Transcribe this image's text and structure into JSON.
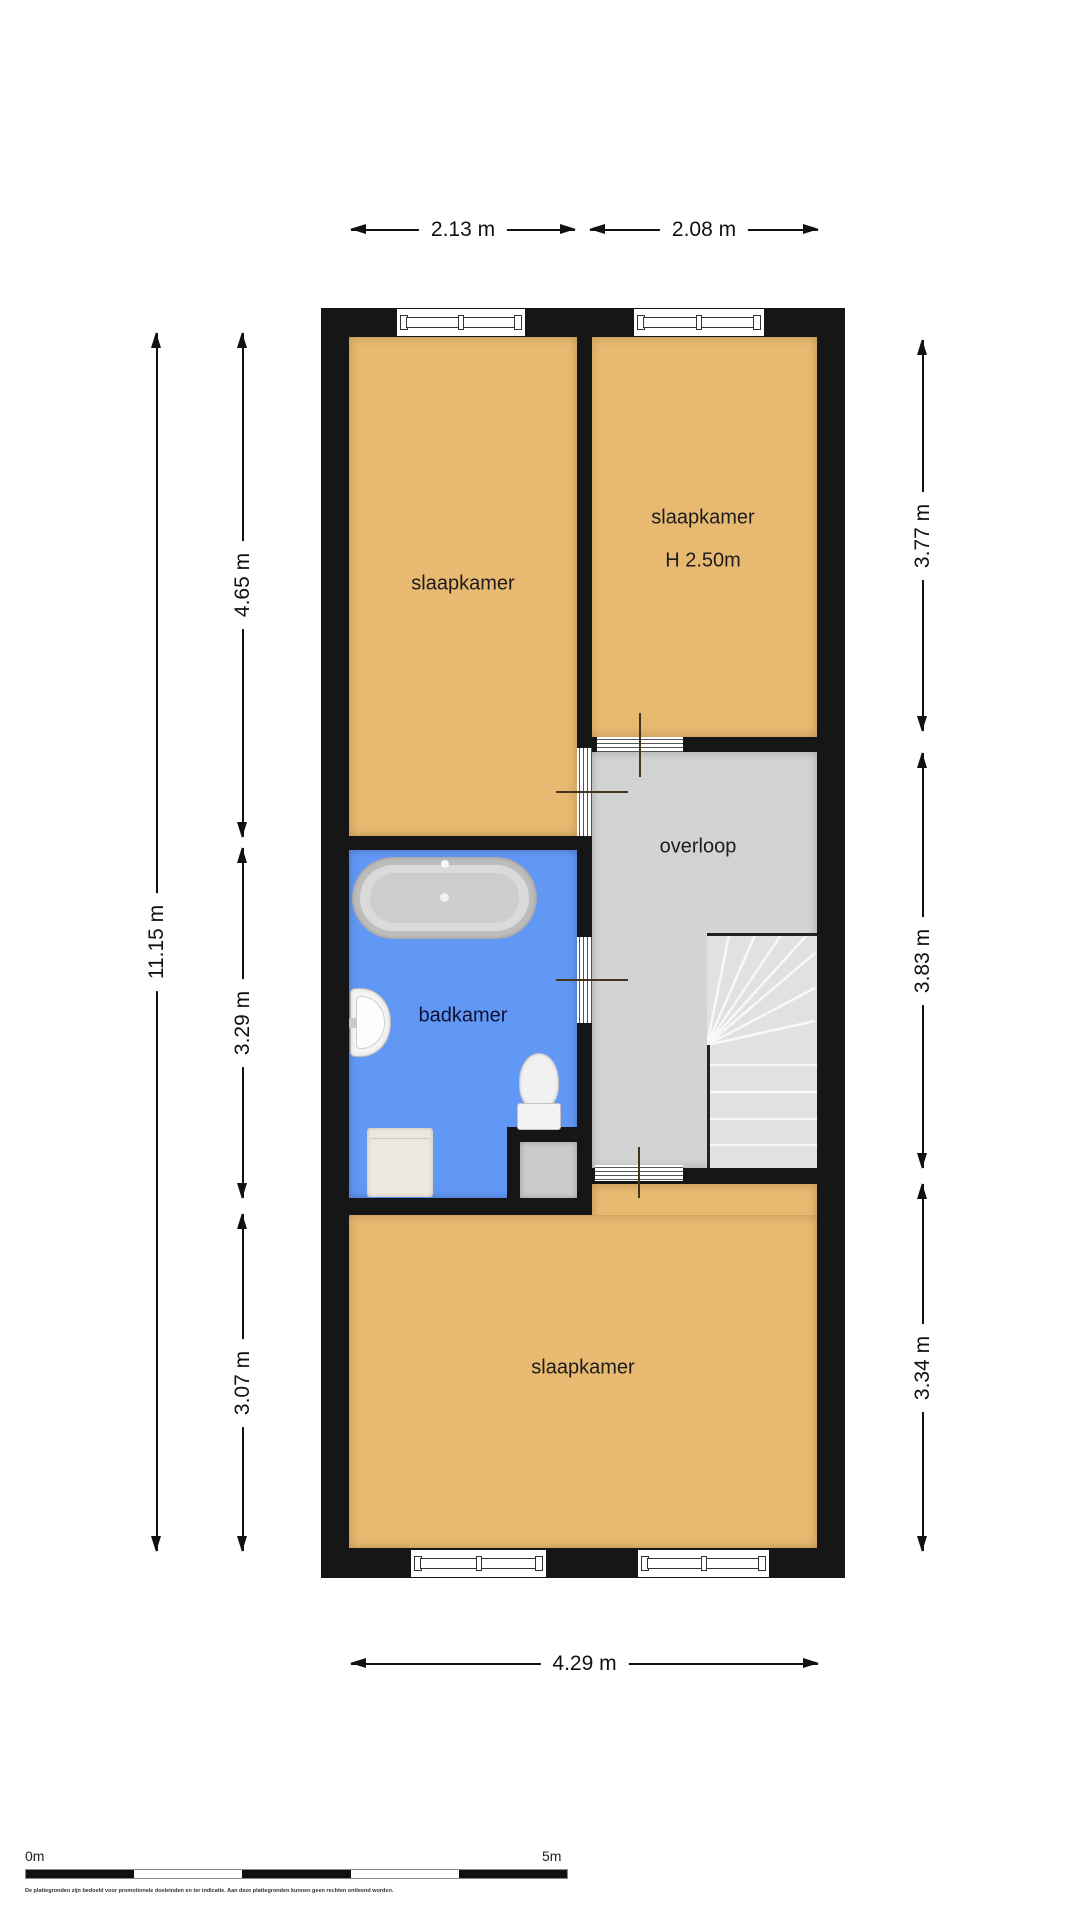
{
  "plan": {
    "rooms": [
      {
        "id": "bedroom-top-left",
        "label": "slaapkamer"
      },
      {
        "id": "bedroom-top-right",
        "label": "slaapkamer",
        "height_note": "H 2.50m"
      },
      {
        "id": "landing",
        "label": "overloop"
      },
      {
        "id": "bathroom",
        "label": "badkamer"
      },
      {
        "id": "bedroom-bottom",
        "label": "slaapkamer"
      }
    ],
    "dimensions": {
      "top_left": "2.13 m",
      "top_right": "2.08 m",
      "bottom": "4.29 m",
      "left_total": "11.15 m",
      "left_top": "4.65 m",
      "left_middle": "3.29 m",
      "left_bottom": "3.07 m",
      "right_top": "3.77 m",
      "right_middle": "3.83 m",
      "right_bottom": "3.34 m"
    },
    "colors": {
      "bedroom_floor": "#e7b971",
      "bathroom_floor": "#6298f5",
      "landing_floor": "#d3d3d3",
      "wall": "#161616"
    },
    "icons": {
      "bathtub": "css-rounded-oval-tub",
      "sink": "css-half-oval-basin",
      "toilet": "css-oval-bowl-with-cistern",
      "washing_machine": "css-square-appliance",
      "window": "css-double-rail-frame",
      "door": "css-striped-opening-with-tick",
      "stairs": "svg-winder-fan-and-treads"
    }
  },
  "scale_bar": {
    "start_label": "0m",
    "end_label": "5m"
  },
  "disclaimer": "De plattegronden zijn bedoeld voor promotionele doeleinden en ter indicatie. Aan deze plattegronden kunnen geen rechten ontleend worden."
}
